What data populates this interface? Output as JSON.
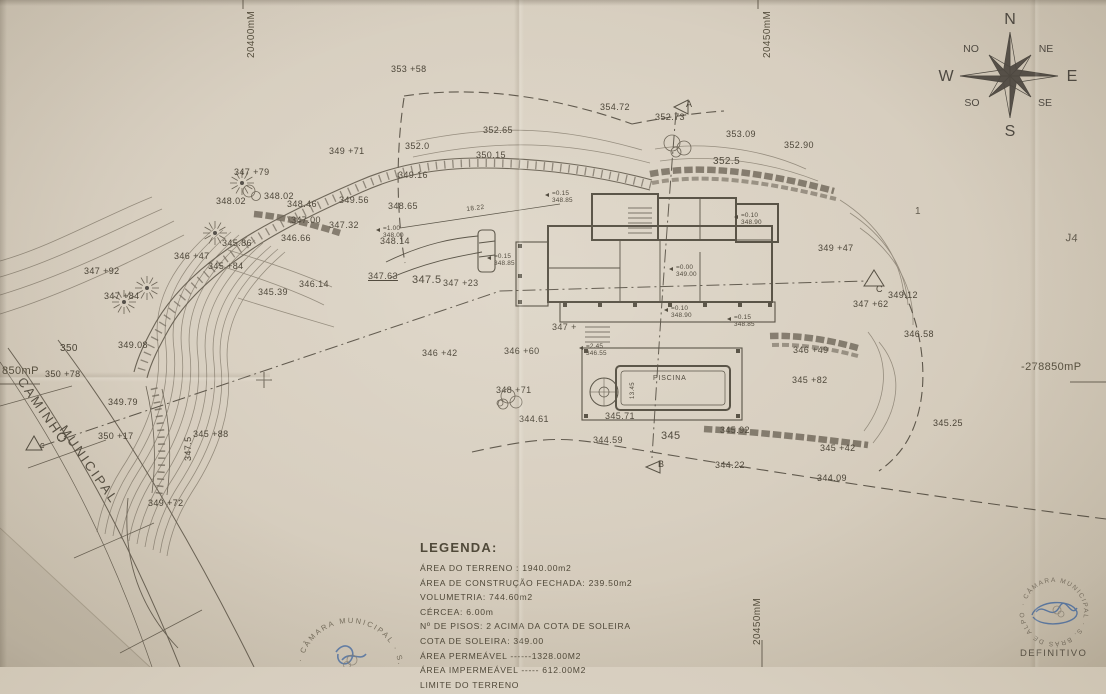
{
  "compass": {
    "n": "N",
    "ne": "NE",
    "e": "E",
    "se": "SE",
    "s": "S",
    "so": "SO",
    "w": "W",
    "no": "NO"
  },
  "grid_references": [
    {
      "t": "20400mM",
      "x": 246,
      "y": 58,
      "r": -90,
      "s": 10
    },
    {
      "t": "20450mM",
      "x": 762,
      "y": 58,
      "r": -90,
      "s": 10
    },
    {
      "t": "20450mM",
      "x": 752,
      "y": 645,
      "r": -90,
      "s": 10
    },
    {
      "t": "-278850mP",
      "x": 1021,
      "y": 361,
      "s": 11
    },
    {
      "t": "850mP",
      "x": 2,
      "y": 365,
      "s": 11
    }
  ],
  "road_labels": [
    {
      "t": "CAMINHO",
      "x": 26,
      "y": 375,
      "r": 55
    },
    {
      "t": "MUNICIPAL",
      "x": 68,
      "y": 423,
      "r": 55
    }
  ],
  "handwritten_marks": [
    {
      "t": "1",
      "x": 915,
      "y": 206,
      "s": 10
    },
    {
      "t": "J4",
      "x": 1066,
      "y": 232,
      "s": 11,
      "r": 4
    }
  ],
  "dimensions": [
    {
      "t": "18.22",
      "x": 466,
      "y": 206,
      "s": 6.5,
      "r": -7
    },
    {
      "t": "13.45",
      "x": 630,
      "y": 399,
      "r": -90,
      "s": 6
    }
  ],
  "spot_elevations": [
    {
      "t": "353 +58",
      "x": 391,
      "y": 65
    },
    {
      "t": "354.72",
      "x": 600,
      "y": 103
    },
    {
      "t": "352.73",
      "x": 655,
      "y": 113
    },
    {
      "t": "A",
      "x": 686,
      "y": 100
    },
    {
      "t": "353.09",
      "x": 726,
      "y": 130
    },
    {
      "t": "352.90",
      "x": 784,
      "y": 141
    },
    {
      "t": "352.5",
      "x": 713,
      "y": 156,
      "s": 10
    },
    {
      "t": "352.65",
      "x": 483,
      "y": 126
    },
    {
      "t": "352.0",
      "x": 405,
      "y": 142
    },
    {
      "t": "350.15",
      "x": 476,
      "y": 151
    },
    {
      "t": "349.16",
      "x": 398,
      "y": 171
    },
    {
      "t": "349 +71",
      "x": 329,
      "y": 147
    },
    {
      "t": "347 +79",
      "x": 234,
      "y": 168
    },
    {
      "t": "348.02",
      "x": 216,
      "y": 197
    },
    {
      "t": "348.02",
      "x": 264,
      "y": 192
    },
    {
      "t": "348.46",
      "x": 287,
      "y": 200
    },
    {
      "t": "349.56",
      "x": 339,
      "y": 196
    },
    {
      "t": "348.65",
      "x": 388,
      "y": 202
    },
    {
      "t": "347.00",
      "x": 291,
      "y": 216
    },
    {
      "t": "347.32",
      "x": 329,
      "y": 221
    },
    {
      "t": "346.66",
      "x": 281,
      "y": 234
    },
    {
      "t": "345.86",
      "x": 222,
      "y": 239
    },
    {
      "t": "346 +47",
      "x": 174,
      "y": 252
    },
    {
      "t": "345 +84",
      "x": 208,
      "y": 262
    },
    {
      "t": "346.14",
      "x": 299,
      "y": 280
    },
    {
      "t": "345.39",
      "x": 258,
      "y": 288
    },
    {
      "t": "347 +92",
      "x": 84,
      "y": 267
    },
    {
      "t": "347 +84",
      "x": 104,
      "y": 292
    },
    {
      "t": "349.08",
      "x": 118,
      "y": 341
    },
    {
      "t": "350",
      "x": 60,
      "y": 343,
      "s": 10
    },
    {
      "t": "350 +78",
      "x": 45,
      "y": 370
    },
    {
      "t": "349.79",
      "x": 108,
      "y": 398
    },
    {
      "t": "350 +17",
      "x": 98,
      "y": 432
    },
    {
      "t": "345 +88",
      "x": 193,
      "y": 430
    },
    {
      "t": "347.5",
      "x": 184,
      "y": 461,
      "r": -90
    },
    {
      "t": "349 +72",
      "x": 148,
      "y": 499
    },
    {
      "t": "347.63",
      "x": 368,
      "y": 272,
      "u": 1
    },
    {
      "t": "347.5",
      "x": 412,
      "y": 274,
      "s": 11
    },
    {
      "t": "347 +23",
      "x": 443,
      "y": 279
    },
    {
      "t": "348.14",
      "x": 380,
      "y": 237
    },
    {
      "t": "349 +47",
      "x": 818,
      "y": 244
    },
    {
      "t": "C",
      "x": 876,
      "y": 285
    },
    {
      "t": "349.12",
      "x": 888,
      "y": 291
    },
    {
      "t": "347 +62",
      "x": 853,
      "y": 300
    },
    {
      "t": "346.58",
      "x": 904,
      "y": 330
    },
    {
      "t": "346 +49",
      "x": 793,
      "y": 346
    },
    {
      "t": "345 +82",
      "x": 792,
      "y": 376
    },
    {
      "t": "345.25",
      "x": 933,
      "y": 419
    },
    {
      "t": "345 +42",
      "x": 820,
      "y": 444
    },
    {
      "t": "344.09",
      "x": 817,
      "y": 474
    },
    {
      "t": "344.22",
      "x": 715,
      "y": 461
    },
    {
      "t": "345.92",
      "x": 720,
      "y": 426
    },
    {
      "t": "345",
      "x": 661,
      "y": 430,
      "s": 11
    },
    {
      "t": "344.59",
      "x": 593,
      "y": 436
    },
    {
      "t": "B",
      "x": 658,
      "y": 460
    },
    {
      "t": "344.61",
      "x": 519,
      "y": 415
    },
    {
      "t": "345.71",
      "x": 605,
      "y": 412
    },
    {
      "t": "PISCINA",
      "x": 653,
      "y": 375,
      "s": 7,
      "ls": 0.8
    },
    {
      "t": "346 +42",
      "x": 422,
      "y": 349
    },
    {
      "t": "346 +60",
      "x": 504,
      "y": 347
    },
    {
      "t": "348 +71",
      "x": 496,
      "y": 386
    },
    {
      "t": "347 +",
      "x": 552,
      "y": 323
    },
    {
      "t": "c",
      "x": 40,
      "y": 441
    }
  ],
  "level_markers": [
    {
      "a": "=0.15",
      "b": "348.85",
      "x": 552,
      "y": 191
    },
    {
      "a": "=0.10",
      "b": "348.90",
      "x": 741,
      "y": 213
    },
    {
      "a": "=0.00",
      "b": "349.00",
      "x": 676,
      "y": 265
    },
    {
      "a": "=0.10",
      "b": "348.90",
      "x": 671,
      "y": 306
    },
    {
      "a": "=0.15",
      "b": "348.85",
      "x": 734,
      "y": 315
    },
    {
      "a": "=1.00",
      "b": "348.00",
      "x": 383,
      "y": 226
    },
    {
      "a": "=0.15",
      "b": "348.85",
      "x": 494,
      "y": 254
    },
    {
      "a": "=2.45",
      "b": "346.55",
      "x": 586,
      "y": 344
    }
  ],
  "legend": {
    "title": "LEGENDA:",
    "items": [
      "ÁREA DO TERRENO : 1940.00m2",
      "ÁREA DE CONSTRUÇÃO FECHADA: 239.50m2",
      "VOLUMETRIA: 744.60m2",
      "CÉRCEA: 6.00m",
      "Nº DE PISOS: 2 ACIMA DA COTA DE SOLEIRA",
      "COTA DE SOLEIRA: 349.00",
      "ÁREA PERMEÁVEL ------1328.00M2",
      "ÁREA IMPERMEÁVEL ----- 612.00M2",
      "LIMITE DO TERRENO"
    ]
  },
  "stamps": {
    "ring_text": "· CÂMARA MUNICIPAL · S. BRÁS DE ALPORTEL ",
    "status": "DEFINITIVO"
  }
}
